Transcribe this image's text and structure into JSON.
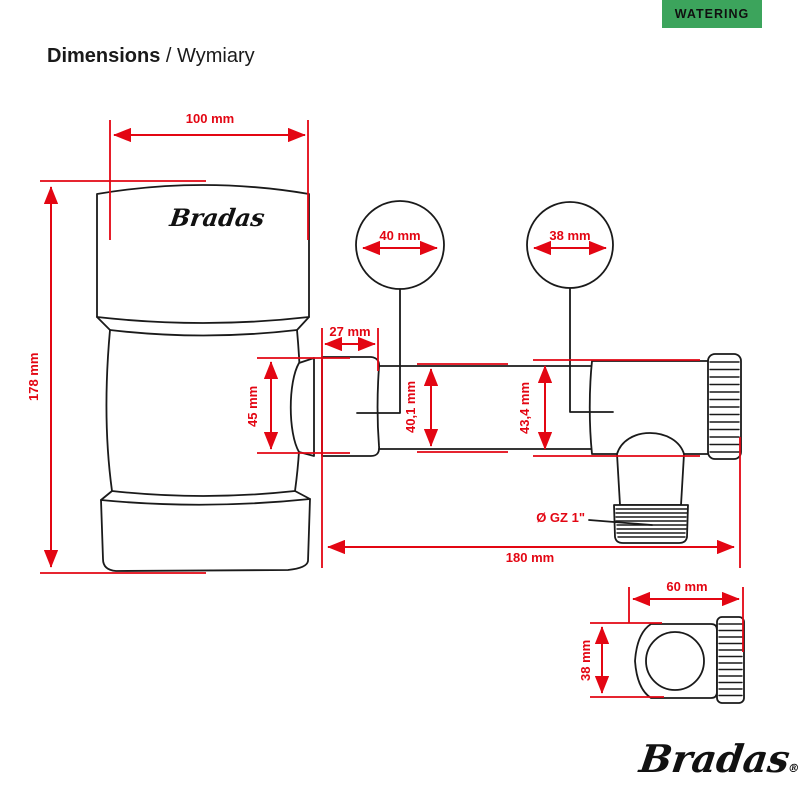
{
  "badge": {
    "label": "WATERING"
  },
  "title": {
    "main": "Dimensions",
    "rest": " / Wymiary"
  },
  "brand": {
    "tank_logo": "Bradas",
    "footer_logo": "Bradas",
    "registered_mark": "®"
  },
  "colors": {
    "dimension_red": "#e30613",
    "line_black": "#1a1a1a",
    "badge_green": "#3ca45c"
  },
  "dims": {
    "tank_width": "100 mm",
    "tank_height": "178 mm",
    "connector_diameter": "45 mm",
    "connector_length": "27 mm",
    "callout_left": "40 mm",
    "callout_right": "38 mm",
    "tube_diameter": "40,1 mm",
    "body_diameter": "43,4 mm",
    "thread_label": "Ø GZ 1\"",
    "total_length": "180 mm",
    "side_width": "60 mm",
    "side_height": "38 mm"
  }
}
